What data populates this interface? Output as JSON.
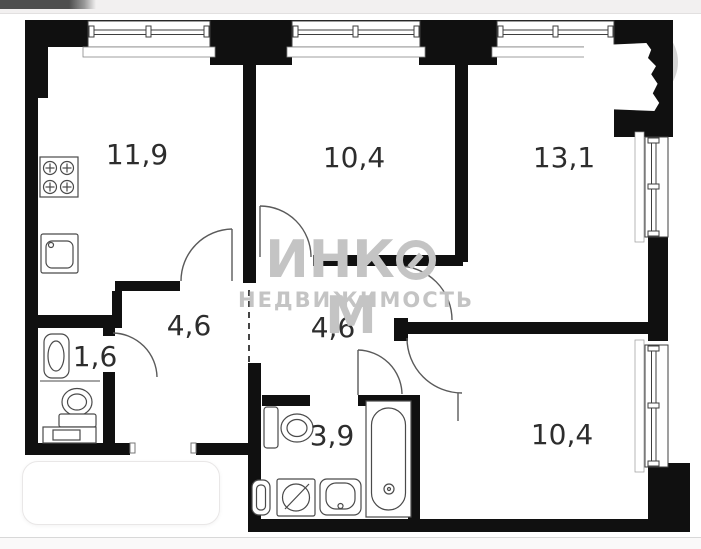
{
  "meta": {
    "title": "Apartment floor plan with watermark",
    "type": "floor-plan-image"
  },
  "watermark": {
    "text": "ИНКОМ",
    "part1": "ИНК",
    "part2": "М",
    "line2": "НЕДВИЖИМОСТЬ",
    "color": "#c4c4c4"
  },
  "rooms": [
    {
      "id": "kitchen",
      "area": "11,9"
    },
    {
      "id": "room-top-middle",
      "area": "10,4"
    },
    {
      "id": "room-top-right",
      "area": "13,1"
    },
    {
      "id": "hallway-left",
      "area": "4,6"
    },
    {
      "id": "hallway-right",
      "area": "4,6"
    },
    {
      "id": "wc",
      "area": "1,6"
    },
    {
      "id": "bathroom",
      "area": "3,9"
    },
    {
      "id": "room-bottom-right",
      "area": "10,4"
    }
  ],
  "fixtures": [
    "stove-icon",
    "kitchen-sink-icon",
    "wc-sink-icon",
    "wc-toilet-icon",
    "wc-cabinet-icon",
    "bathroom-toilet-icon",
    "water-heater-icon",
    "washing-machine-icon",
    "bathroom-sink-icon",
    "bathtub-icon",
    "window-icon",
    "door-arc-icon"
  ],
  "colors": {
    "wall": "#101010",
    "line": "#4a4a4a",
    "label": "#2d2d2d",
    "watermark": "#c4c4c4",
    "topbar": "#f2f0f0"
  }
}
